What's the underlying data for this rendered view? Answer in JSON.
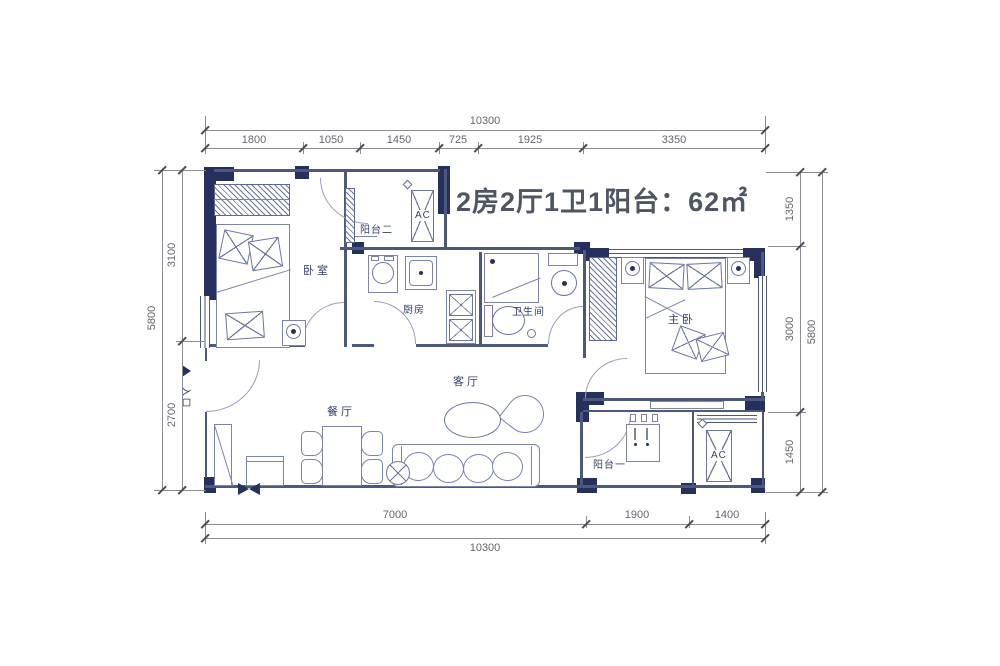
{
  "title": {
    "text": "2房2厅1卫1阳台：62㎡"
  },
  "entrance": {
    "label": "入口"
  },
  "rooms": {
    "bedroom": "卧室",
    "balcony2": "阳台二",
    "kitchen": "厨房",
    "bathroom": "卫生间",
    "living": "客厅",
    "dining": "餐厅",
    "master": "主卧",
    "balcony1": "阳台一",
    "ac_top": "AC",
    "ac_bottom": "AC"
  },
  "dimensions": {
    "top": {
      "total": "10300",
      "segments": [
        "1800",
        "1050",
        "1450",
        "725",
        "1925",
        "3350"
      ]
    },
    "bottom": {
      "total": "10300",
      "segments": [
        "7000",
        "1900",
        "1400"
      ]
    },
    "left": {
      "total": "5800",
      "segments": [
        "3100",
        "2700"
      ]
    },
    "right": {
      "total": "5800",
      "segments": [
        "1350",
        "3000",
        "1450"
      ]
    }
  },
  "colors": {
    "wall": "#26305c",
    "furniture_line": "#6b76a0",
    "thin_wall": "#4d587f",
    "dimension_text": "#63666c",
    "room_label_text": "#333e6d",
    "title_text": "#4f5663"
  }
}
